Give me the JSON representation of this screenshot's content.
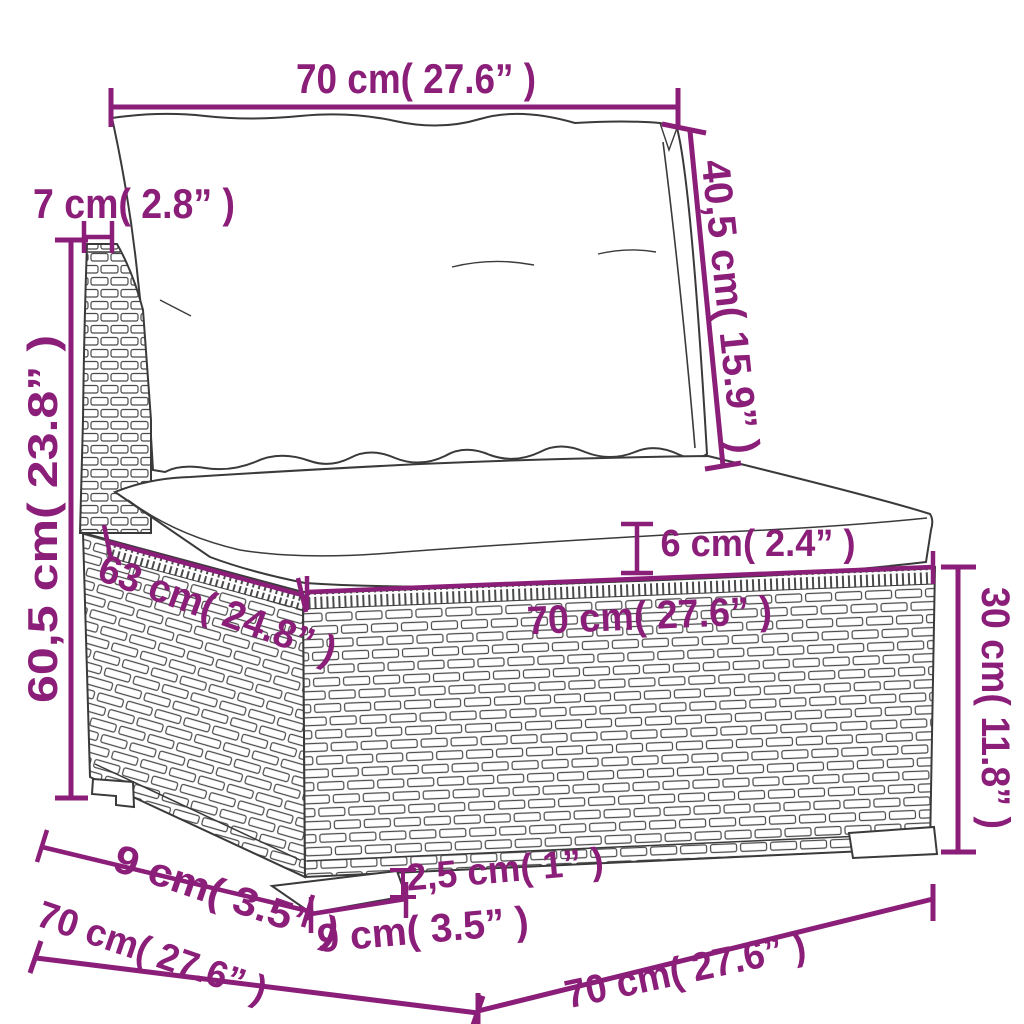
{
  "diagram": {
    "description": "rattan garden sofa middle-section dimension drawing",
    "colors": {
      "annotation": "#8a1e78",
      "line_art": "#3a3a3a",
      "background": "#ffffff"
    },
    "labels": {
      "top_width": "70 cm( 27.6” )",
      "back_post_width": "7 cm( 2.8” )",
      "back_cushion_height": "40,5 cm( 15.9” )",
      "total_height": "60,5 cm( 23.8” )",
      "seat_depth": "63 cm( 24.8” )",
      "seat_cushion_thickness": "6 cm( 2.4” )",
      "base_height": "30 cm( 11.8” )",
      "base_width": "70 cm( 27.6” )",
      "foot_height": "2,5 cm( 1” )",
      "foot_width": "9 cm( 3.5” )",
      "foot_depth": "9 cm( 3.5” )",
      "total_depth": "70 cm( 27.6” )",
      "bottom_width": "70 cm( 27.6” )"
    }
  }
}
